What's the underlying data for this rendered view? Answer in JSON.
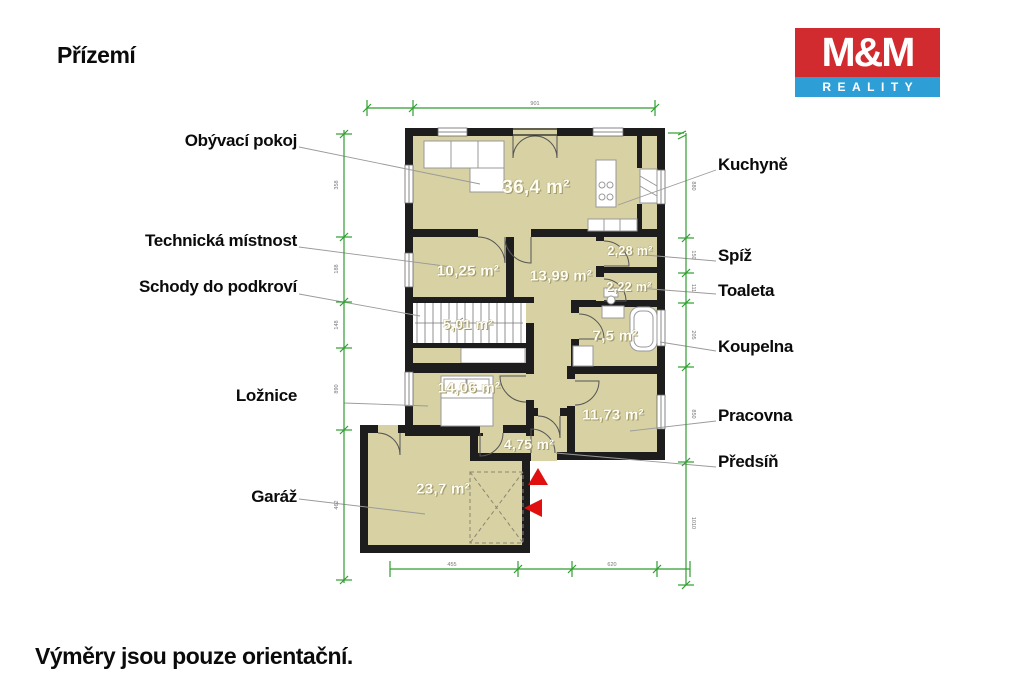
{
  "page": {
    "title": "Přízemí",
    "disclaimer": "Výměry jsou pouze orientační."
  },
  "logo": {
    "top_text": "M&M",
    "bottom_text": "REALITY"
  },
  "floor_labels": {
    "obyvaci_pokoj": "Obývací pokoj",
    "technicka_mistnost": "Technická místnost",
    "schody_do_podkrovi": "Schody do podkroví",
    "loznice": "Ložnice",
    "garaz": "Garáž",
    "kuchyne": "Kuchyně",
    "spiz": "Spíž",
    "toaleta": "Toaleta",
    "koupelna": "Koupelna",
    "pracovna": "Pracovna",
    "predsin": "Předsíň"
  },
  "areas": {
    "obyvaci_pokoj": "36,4 m²",
    "technicka_mistnost": "10,25 m²",
    "chodba": "13,99 m²",
    "spiz": "2,28 m²",
    "toaleta": "2,22 m²",
    "schody": "5,01 m²",
    "koupelna": "7,5 m²",
    "loznice": "14,06 m²",
    "pracovna": "11,73 m²",
    "predsin": "4,75 m²",
    "garaz": "23,7 m²"
  },
  "dimensions": {
    "top": "901",
    "bottom": [
      "455",
      "620"
    ],
    "left": [
      "358",
      "188",
      "148",
      "890",
      "462"
    ],
    "right": [
      "880",
      "150",
      "111",
      "205",
      "850",
      "1010"
    ]
  },
  "colors": {
    "room_fill": "#d7d1a3",
    "wall": "#1d1d1d",
    "dimension_green": "#2f9e2f",
    "arrow_red": "#e01010",
    "logo_red": "#d22b2f",
    "logo_blue": "#2e9fd6"
  }
}
